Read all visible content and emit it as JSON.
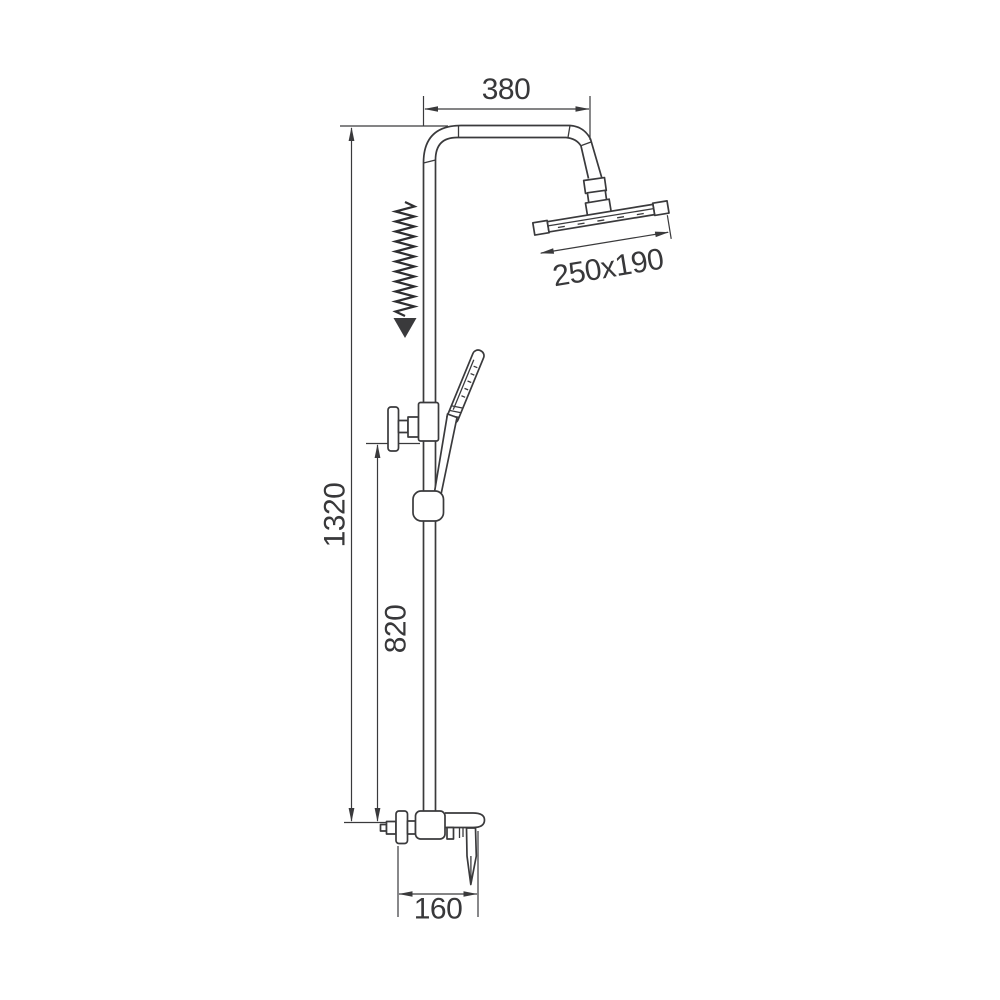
{
  "drawing": {
    "background_color": "#ffffff",
    "line_color": "#3a3a3c",
    "text_color": "#38383a",
    "labels": {
      "top_width": "380",
      "head_size": "250x190",
      "total_height": "1320",
      "bracket_height": "820",
      "mixer_width": "160"
    },
    "parts": [
      "riser-pipe",
      "shower-arm",
      "ball-joint",
      "rain-shower-head",
      "hose-pull-arrow",
      "wall-bracket",
      "hand-shower",
      "hand-shower-holder",
      "mixer-valve",
      "mixer-lever",
      "wall-flange",
      "mixer-spout"
    ]
  }
}
